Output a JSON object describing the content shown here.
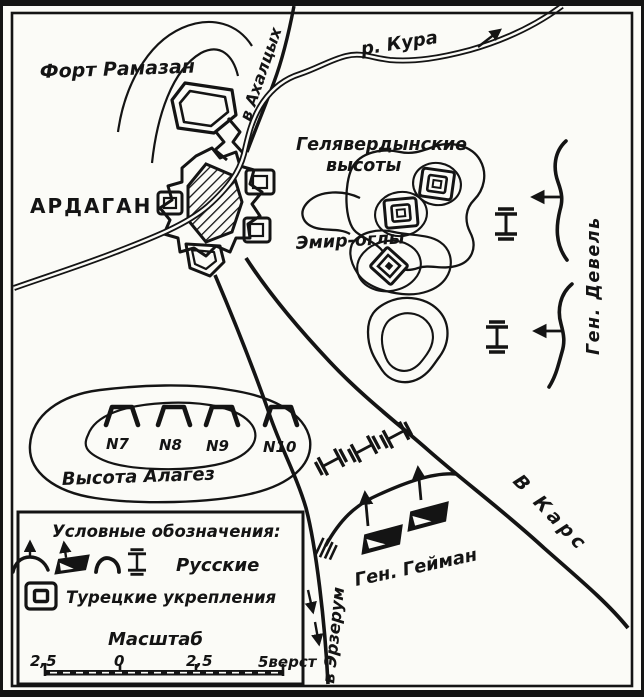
{
  "map": {
    "labels": {
      "fort_ramazan": "Форт Рамазан",
      "city": "АРДАГАН",
      "river": "р. Кура",
      "road_akhaltsykh": "в Ахалцых",
      "heights_line1": "Гелявердынские",
      "heights_line2": "высоты",
      "emir_ogly": "Эмир-оглы",
      "gen_devel": "Ген. Девель",
      "alagez": "Высота Алагез",
      "gen_geyman": "Ген. Гейман",
      "to_kars": "В Карс",
      "to_erzerum": "в Эрзерум"
    },
    "redoubts": [
      "N7",
      "N8",
      "N9",
      "N10"
    ]
  },
  "legend": {
    "title": "Условные обозначения:",
    "russians": "Русские",
    "turkish": "Турецкие укрепления",
    "scale_title": "Масштаб",
    "scale_ticks": [
      "2,5",
      "0",
      "2,5",
      "5верст"
    ]
  },
  "colors": {
    "ink": "#141414",
    "paper": "#fbfbf7"
  }
}
